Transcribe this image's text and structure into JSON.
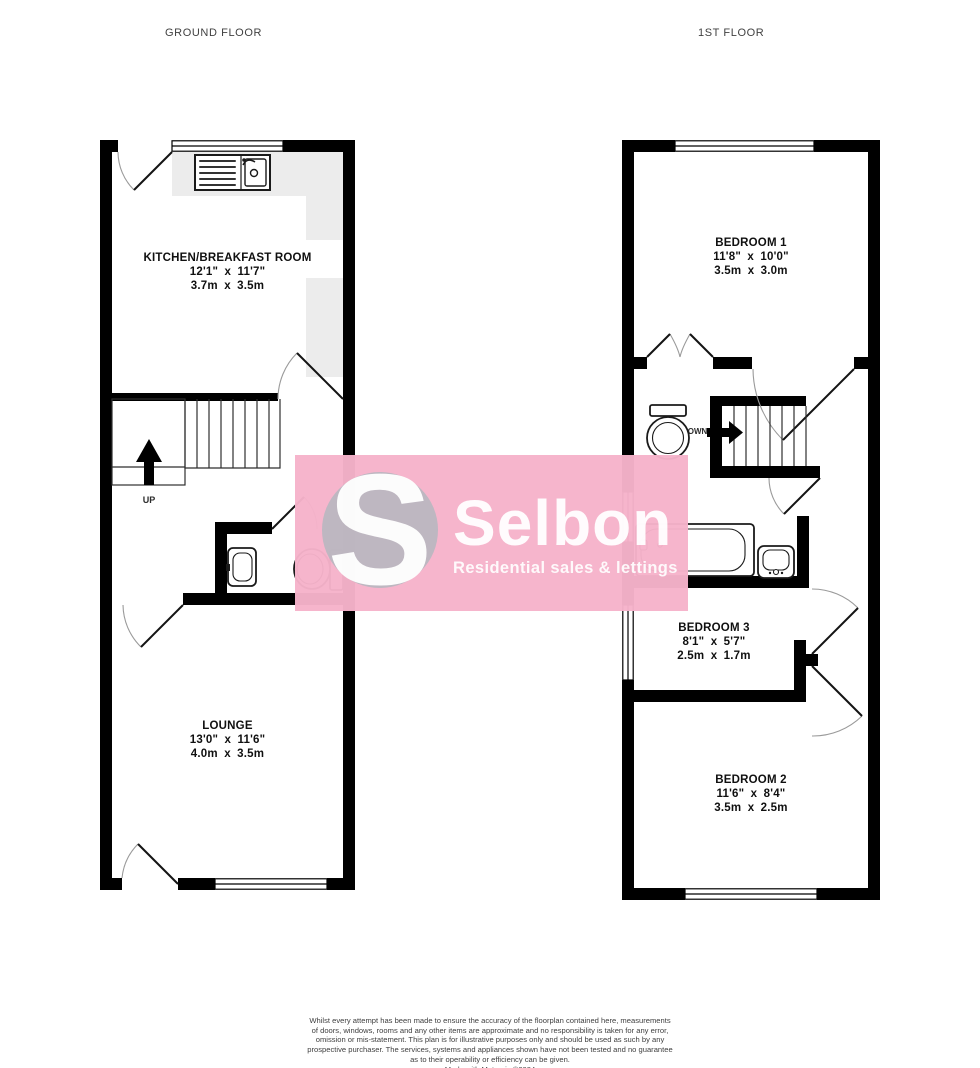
{
  "floors": {
    "ground": {
      "title": "GROUND FLOOR"
    },
    "first": {
      "title": "1ST FLOOR"
    }
  },
  "rooms": {
    "kitchen": {
      "name": "KITCHEN/BREAKFAST ROOM",
      "imperial": "12'1\" x 11'7\"",
      "metric": "3.7m x 3.5m"
    },
    "lounge": {
      "name": "LOUNGE",
      "imperial": "13'0\" x 11'6\"",
      "metric": "4.0m x 3.5m"
    },
    "bedroom1": {
      "name": "BEDROOM 1",
      "imperial": "11'8\" x 10'0\"",
      "metric": "3.5m x 3.0m"
    },
    "bedroom2": {
      "name": "BEDROOM 2",
      "imperial": "11'6\" x 8'4\"",
      "metric": "3.5m x 2.5m"
    },
    "bedroom3": {
      "name": "BEDROOM 3",
      "imperial": "8'1\" x 5'7\"",
      "metric": "2.5m x 1.7m"
    }
  },
  "stairs": {
    "up_label": "UP",
    "down_label": "DOWN"
  },
  "watermark": {
    "brand_initial": "S",
    "brand": "Selbon",
    "tagline": "Residential sales & lettings",
    "pink": "#f6b3cb",
    "circle_gray": "#b4b7bf"
  },
  "footer": {
    "lines": [
      "Whilst every attempt has been made to ensure the accuracy of the floorplan contained here, measurements",
      "of doors, windows, rooms and any other items are approximate and no responsibility is taken for any error,",
      "omission or mis-statement. This plan is for illustrative purposes only and should be used as such by any",
      "prospective purchaser. The services, systems and appliances shown have not been tested and no guarantee",
      "as to their operability or efficiency can be given.",
      "Made with Metropix ©2024"
    ]
  }
}
